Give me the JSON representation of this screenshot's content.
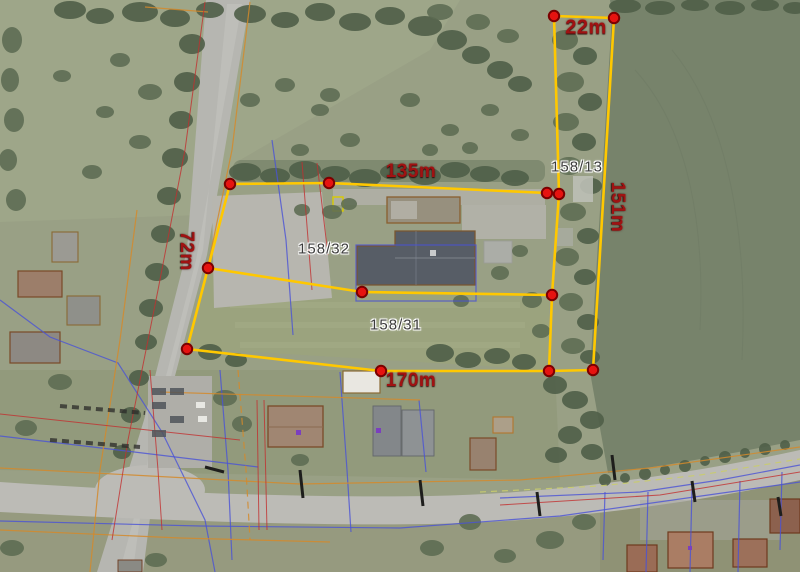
{
  "map_overlay": {
    "measurements": {
      "strip_top": "22m",
      "north": "135m",
      "east": "151m",
      "west": "72m",
      "south": "170m"
    },
    "parcels": {
      "strip": "158/13",
      "north_parcel": "158/32",
      "south_parcel": "158/31"
    }
  },
  "colors": {
    "measure_line": "#FFC800",
    "vertex_fill": "#E61310",
    "vertex_ring": "#7A0000",
    "measure_label": "#A01212",
    "parcel_label": "#3C3C3C",
    "parcel_label_halo": "#FFFFFF",
    "cadastral_blue": "#4A53D6",
    "cadastral_orange": "#D4892B",
    "cadastral_red": "#C23030"
  }
}
